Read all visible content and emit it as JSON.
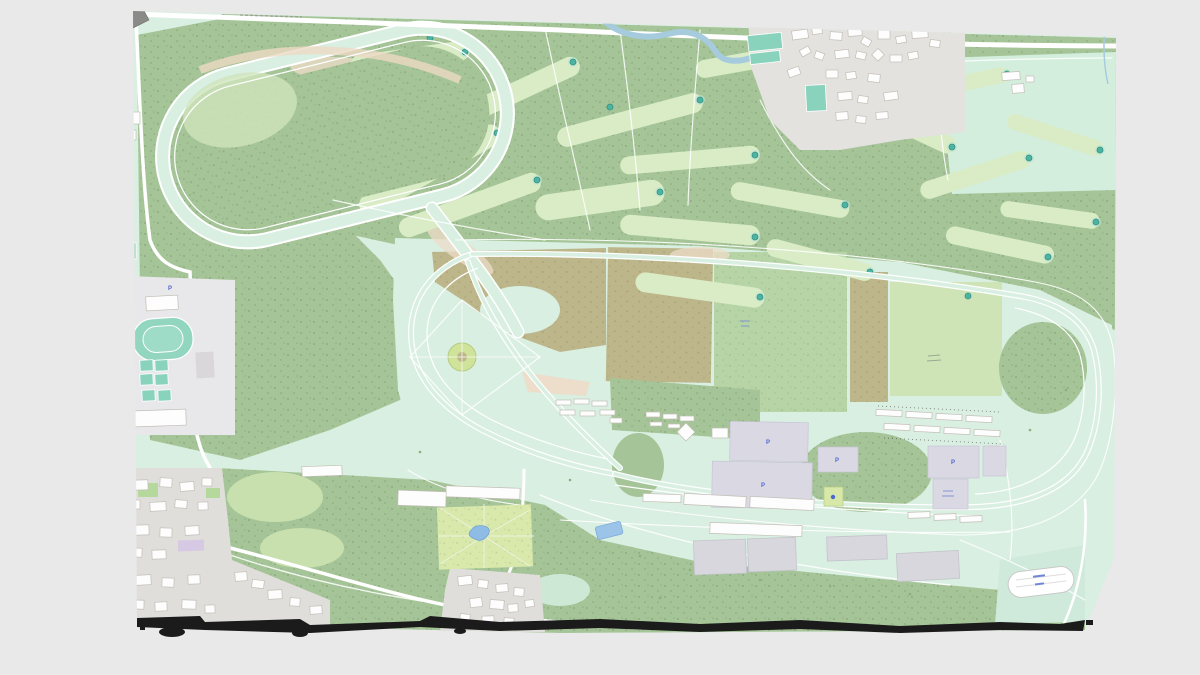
{
  "scene": {
    "type": "3d-web-map-screenshot",
    "description": "Slightly tilted rendered map of a large racecourse with an interior golf course, training oval, stables, grandstands, parking lots, sports complex and surrounding villages",
    "background_color": "#e9e9e9",
    "torn_edge_color": "#1b1b1b"
  },
  "map": {
    "parking_label": "P",
    "colors": {
      "mint_turf": "#d9efe1",
      "forest": "#a5c497",
      "fairway": "#d9ecc6",
      "scrub_khaki": "#bdb68b",
      "scrub_pink": "#eedcc8",
      "field_light": "#cfe4b6",
      "field_medium": "#b6d4a5",
      "park_lawn": "#d9e9ab",
      "water": "#a6cbdd",
      "sports_pitch": "#89d2bc",
      "parking_lot": "#dad8e3",
      "building": "#fdfdfd",
      "road": "#ffffff",
      "label_blue": "#4f68cf"
    },
    "features": [
      "training-oval-track",
      "golf-course-fairways",
      "golf-greens",
      "main-racecourse-oval",
      "diagonal-chute",
      "infield-roundabout",
      "khaki-scrub-fields",
      "patchwork-fields",
      "village-north-east",
      "farm-buildings",
      "river",
      "sports-pitches",
      "athletics-track",
      "tennis-courts",
      "urban-blocks-south-west",
      "star-path-park",
      "ponds",
      "grandstands",
      "stable-rows",
      "parking-lots",
      "playground",
      "practice-ring",
      "torn-map-edge"
    ]
  }
}
